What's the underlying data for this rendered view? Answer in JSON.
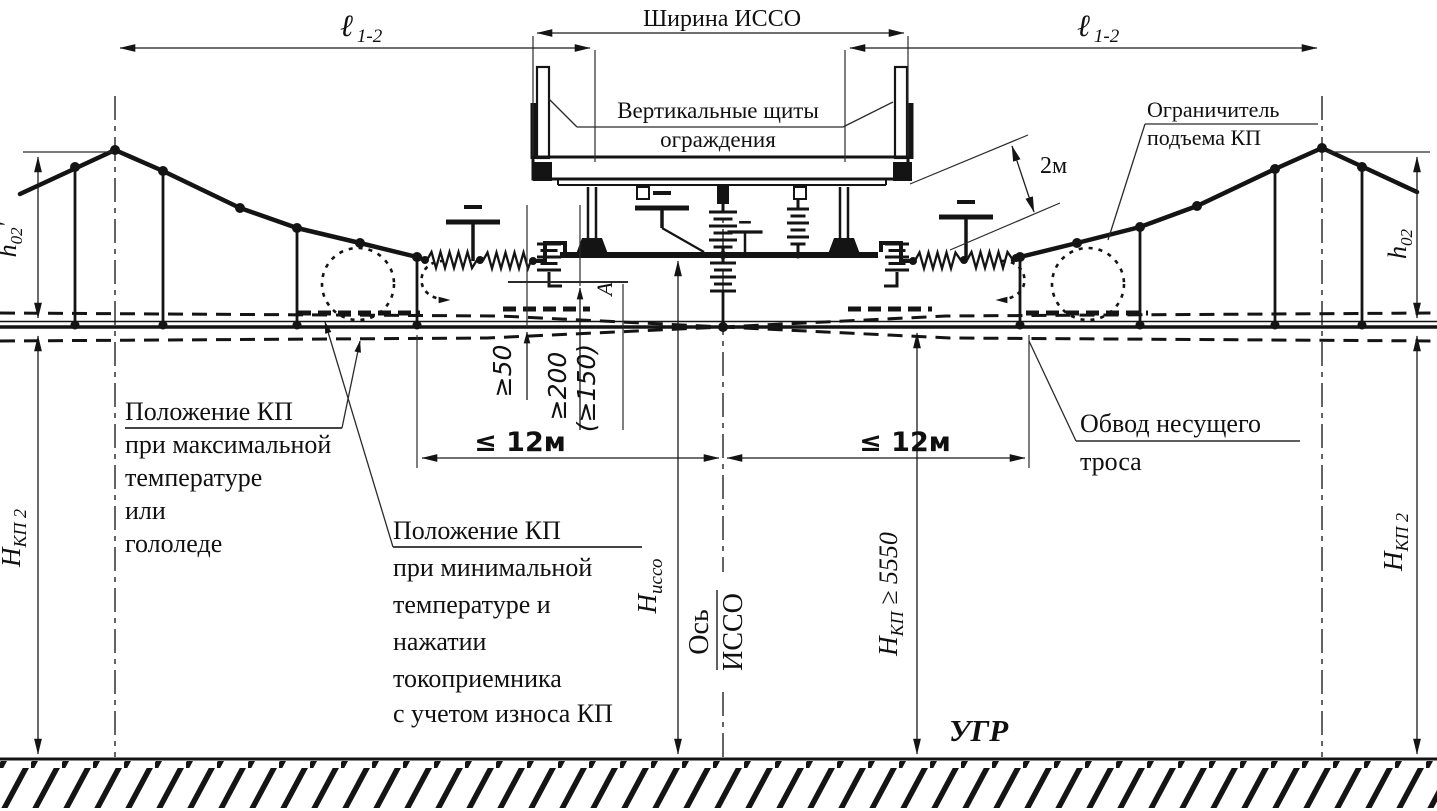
{
  "diagram": {
    "colors": {
      "ink": "#141414",
      "paper": "#ffffff"
    },
    "dims": {
      "width_isso": "Ширина ИССО",
      "span": {
        "sym": "ℓ",
        "sub": "1-2"
      },
      "two_m": "2м",
      "h02_left": {
        "b": "h",
        "s": "02",
        "p": "'"
      },
      "h02_right": {
        "b": "h",
        "s": "02"
      },
      "hkp2": {
        "b": "Н",
        "s": "КП 2"
      },
      "h_isso": {
        "b": "Н",
        "s": "иссо"
      },
      "h_kp": {
        "b": "Н",
        "s": "КП",
        "r": " ≥ 5550"
      },
      "le12": "≤ 12м",
      "ge50": "≥50",
      "ge200": "≥200",
      "ge150": "(≥150)"
    },
    "labels": {
      "shields": [
        "Вертикальные щиты",
        "ограждения"
      ],
      "limiter": [
        "Ограничитель",
        "подъема КП"
      ],
      "kp_max": [
        "Положение КП",
        "при максимальной",
        "температуре",
        "или",
        "гололеде"
      ],
      "kp_min": [
        "Положение КП",
        "при минимальной",
        "температуре и",
        "нажатии",
        "токоприемника",
        "с учетом износа КП"
      ],
      "bypass": [
        "Обвод несущего",
        "троса"
      ],
      "axis": [
        "Ось",
        "ИССО"
      ],
      "rail_level": "УГР",
      "section_mark": "А"
    }
  }
}
